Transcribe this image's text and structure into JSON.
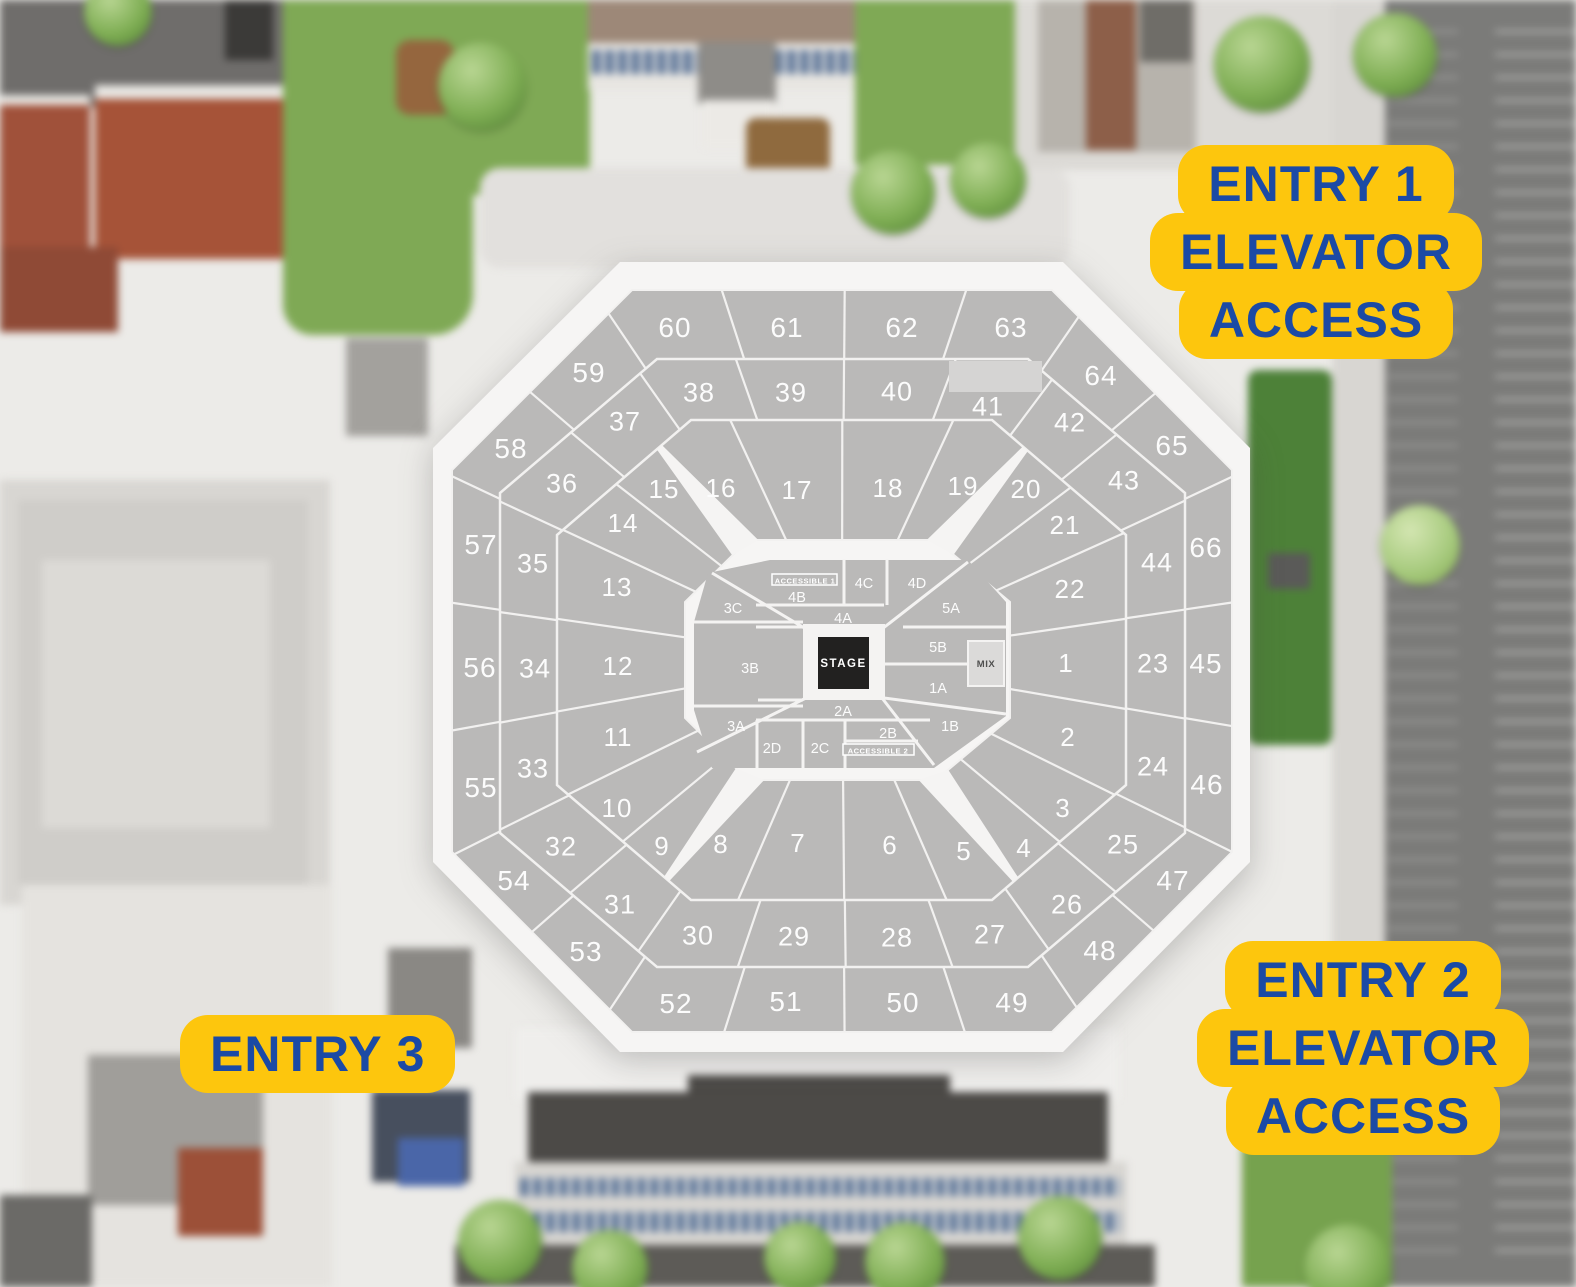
{
  "palette": {
    "badge_yellow": "#fdc60d",
    "badge_blue": "#1b4aa5",
    "bowl_gray": "#bab9b8",
    "concourse_white": "#f6f5f4",
    "aisle_white": "#f4f3f2",
    "stage_black": "#222120",
    "suite_gray": "#d5d4d3",
    "mix_gray": "#dbdad9",
    "label_white": "#fcfcfc"
  },
  "badges": {
    "entry1": {
      "line1": "ENTRY 1",
      "line2": "ELEVATOR",
      "line3": "ACCESS"
    },
    "entry2": {
      "line1": "ENTRY 2",
      "line2": "ELEVATOR",
      "line3": "ACCESS"
    },
    "entry3": {
      "line1": "ENTRY 3"
    }
  },
  "map": {
    "stage": {
      "label": "STAGE"
    },
    "mix": {
      "label": "MIX"
    },
    "arrow_aisles": [
      [
        "15",
        "16"
      ],
      [
        "19",
        "20"
      ],
      [
        "8",
        "9"
      ],
      [
        "4",
        "5"
      ]
    ],
    "rings": {
      "inner": [
        {
          "label": "1",
          "x": 1066,
          "y": 663
        },
        {
          "label": "2",
          "x": 1068,
          "y": 737
        },
        {
          "label": "3",
          "x": 1063,
          "y": 808
        },
        {
          "label": "4",
          "x": 1024,
          "y": 848
        },
        {
          "label": "5",
          "x": 964,
          "y": 851
        },
        {
          "label": "6",
          "x": 890,
          "y": 845
        },
        {
          "label": "7",
          "x": 798,
          "y": 843
        },
        {
          "label": "8",
          "x": 721,
          "y": 844
        },
        {
          "label": "9",
          "x": 662,
          "y": 846
        },
        {
          "label": "10",
          "x": 617,
          "y": 808
        },
        {
          "label": "11",
          "x": 618,
          "y": 737
        },
        {
          "label": "12",
          "x": 618,
          "y": 666
        },
        {
          "label": "13",
          "x": 617,
          "y": 587
        },
        {
          "label": "14",
          "x": 623,
          "y": 523
        },
        {
          "label": "15",
          "x": 664,
          "y": 489
        },
        {
          "label": "16",
          "x": 721,
          "y": 488
        },
        {
          "label": "17",
          "x": 797,
          "y": 490
        },
        {
          "label": "18",
          "x": 888,
          "y": 488
        },
        {
          "label": "19",
          "x": 963,
          "y": 486
        },
        {
          "label": "20",
          "x": 1026,
          "y": 489
        },
        {
          "label": "21",
          "x": 1065,
          "y": 525
        },
        {
          "label": "22",
          "x": 1070,
          "y": 589
        }
      ],
      "middle": [
        {
          "label": "23",
          "x": 1153,
          "y": 663
        },
        {
          "label": "24",
          "x": 1153,
          "y": 766
        },
        {
          "label": "25",
          "x": 1123,
          "y": 844
        },
        {
          "label": "26",
          "x": 1067,
          "y": 904
        },
        {
          "label": "27",
          "x": 990,
          "y": 934
        },
        {
          "label": "28",
          "x": 897,
          "y": 937
        },
        {
          "label": "29",
          "x": 794,
          "y": 936
        },
        {
          "label": "30",
          "x": 698,
          "y": 935
        },
        {
          "label": "31",
          "x": 620,
          "y": 904
        },
        {
          "label": "32",
          "x": 561,
          "y": 846
        },
        {
          "label": "33",
          "x": 533,
          "y": 768
        },
        {
          "label": "34",
          "x": 535,
          "y": 668
        },
        {
          "label": "35",
          "x": 533,
          "y": 563
        },
        {
          "label": "36",
          "x": 562,
          "y": 483
        },
        {
          "label": "37",
          "x": 625,
          "y": 421
        },
        {
          "label": "38",
          "x": 699,
          "y": 392
        },
        {
          "label": "39",
          "x": 791,
          "y": 392
        },
        {
          "label": "40",
          "x": 897,
          "y": 391
        },
        {
          "label": "41",
          "x": 988,
          "y": 406
        },
        {
          "label": "42",
          "x": 1070,
          "y": 422
        },
        {
          "label": "43",
          "x": 1124,
          "y": 480
        },
        {
          "label": "44",
          "x": 1157,
          "y": 562
        }
      ],
      "outer": [
        {
          "label": "45",
          "x": 1206,
          "y": 663
        },
        {
          "label": "46",
          "x": 1207,
          "y": 784
        },
        {
          "label": "47",
          "x": 1173,
          "y": 880
        },
        {
          "label": "48",
          "x": 1100,
          "y": 950
        },
        {
          "label": "49",
          "x": 1012,
          "y": 1002
        },
        {
          "label": "50",
          "x": 903,
          "y": 1002
        },
        {
          "label": "51",
          "x": 786,
          "y": 1001
        },
        {
          "label": "52",
          "x": 676,
          "y": 1003
        },
        {
          "label": "53",
          "x": 586,
          "y": 951
        },
        {
          "label": "54",
          "x": 514,
          "y": 880
        },
        {
          "label": "55",
          "x": 481,
          "y": 787
        },
        {
          "label": "56",
          "x": 480,
          "y": 667
        },
        {
          "label": "57",
          "x": 481,
          "y": 544
        },
        {
          "label": "58",
          "x": 511,
          "y": 448
        },
        {
          "label": "59",
          "x": 589,
          "y": 372
        },
        {
          "label": "60",
          "x": 675,
          "y": 327
        },
        {
          "label": "61",
          "x": 787,
          "y": 327
        },
        {
          "label": "62",
          "x": 902,
          "y": 327
        },
        {
          "label": "63",
          "x": 1011,
          "y": 327
        },
        {
          "label": "64",
          "x": 1101,
          "y": 375
        },
        {
          "label": "65",
          "x": 1172,
          "y": 445
        },
        {
          "label": "66",
          "x": 1206,
          "y": 547
        }
      ]
    },
    "floor": [
      {
        "label": "3C",
        "x": 733,
        "y": 608
      },
      {
        "label": "4B",
        "x": 797,
        "y": 597
      },
      {
        "label": "ACCESSIBLE 1",
        "x": 805,
        "y": 581,
        "cls": "acc"
      },
      {
        "label": "4C",
        "x": 864,
        "y": 583
      },
      {
        "label": "4D",
        "x": 917,
        "y": 583
      },
      {
        "label": "4A",
        "x": 843,
        "y": 618
      },
      {
        "label": "5A",
        "x": 951,
        "y": 608
      },
      {
        "label": "5B",
        "x": 938,
        "y": 647
      },
      {
        "label": "1A",
        "x": 938,
        "y": 688
      },
      {
        "label": "3B",
        "x": 750,
        "y": 668
      },
      {
        "label": "2A",
        "x": 843,
        "y": 711
      },
      {
        "label": "1B",
        "x": 950,
        "y": 726
      },
      {
        "label": "2B",
        "x": 888,
        "y": 733
      },
      {
        "label": "ACCESSIBLE 2",
        "x": 878,
        "y": 751,
        "cls": "acc"
      },
      {
        "label": "2C",
        "x": 820,
        "y": 748
      },
      {
        "label": "2D",
        "x": 772,
        "y": 748
      },
      {
        "label": "3A",
        "x": 736,
        "y": 726
      }
    ]
  }
}
